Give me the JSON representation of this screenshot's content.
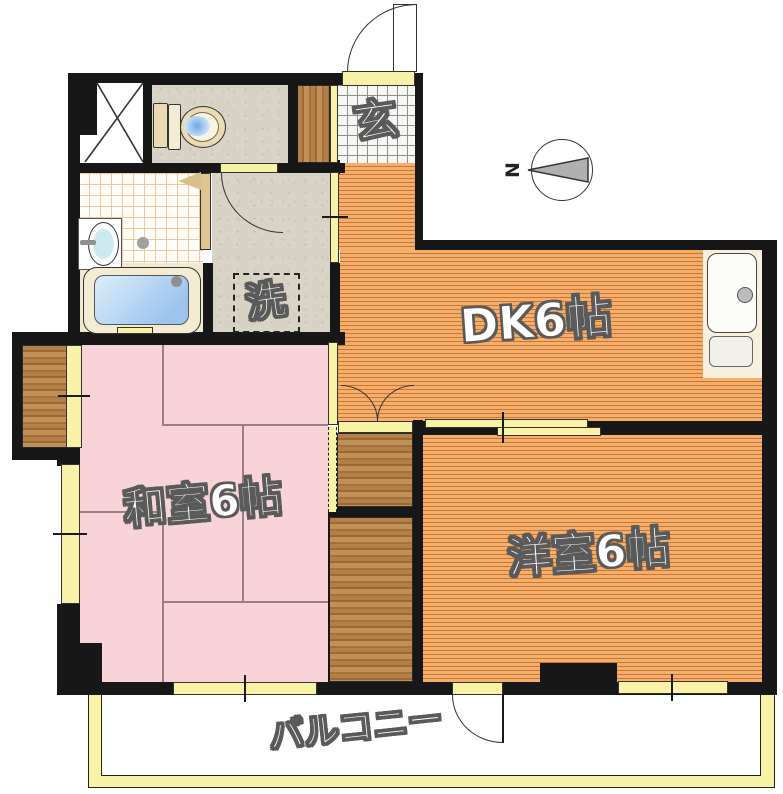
{
  "title": "2DK floor plan",
  "labels": {
    "genkan": "玄",
    "laundry": "洗",
    "dk": "DK6帖",
    "washitsu": "和室6帖",
    "yoshitsu": "洋室6帖",
    "balcony": "バルコニー",
    "north": "N"
  },
  "rooms": [
    {
      "name": "DK",
      "size_jo": 6
    },
    {
      "name": "和室",
      "size_jo": 6
    },
    {
      "name": "洋室",
      "size_jo": 6
    },
    {
      "name": "バルコニー",
      "size_jo": null
    }
  ],
  "fixtures": [
    "toilet",
    "bathtub",
    "washbasin",
    "kitchen-sink",
    "washing-machine-space",
    "entrance",
    "pipe-space",
    "closets"
  ],
  "compass": {
    "direction": "north-left"
  },
  "colors": {
    "wall": "#171717",
    "flooring_light": "#f5ae6e",
    "flooring_dark": "#c7782f",
    "tatami": "#f8d3d8",
    "stone": "#d9d3c6",
    "fixture_yellow": "#f7f2a6",
    "wood": "#ab7840",
    "water": "#9ec4ee"
  }
}
